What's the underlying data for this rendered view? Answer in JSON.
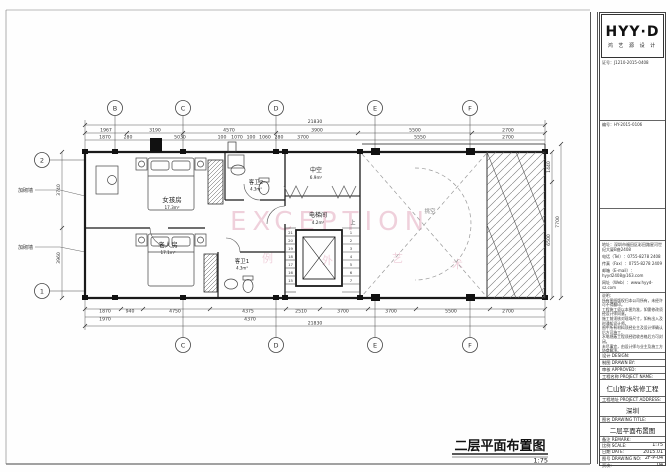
{
  "plan": {
    "axes_top": [
      "B",
      "C",
      "D",
      "E",
      "F"
    ],
    "axes_bottom": [
      "C",
      "D",
      "E",
      "F"
    ],
    "axes_left": [
      "2",
      "1"
    ],
    "dims": {
      "top_total": "21830",
      "top1": [
        "1967",
        "3190",
        "4570",
        "3900",
        "5500",
        "2700"
      ],
      "top2": [
        "1870",
        "280",
        "5030",
        "100",
        "1070",
        "100",
        "1060",
        "280",
        "3700",
        "5550",
        "2700"
      ],
      "bottom1": [
        "1870",
        "940",
        "4750",
        "4375",
        "2510",
        "3700",
        "3700",
        "5500",
        "2700"
      ],
      "bottom2": [
        "1970",
        "4370"
      ],
      "bottom_total": "21830",
      "right": [
        "1440",
        "6500",
        "7700"
      ],
      "left": [
        "3740",
        "3960"
      ]
    },
    "rooms": [
      {
        "name": "女孩房",
        "area": "17.3m²"
      },
      {
        "name": "客卫2",
        "area": "4.3m²"
      },
      {
        "name": "中空",
        "area": "6.9m²"
      },
      {
        "name": "电梯间",
        "area": "4.2m²"
      },
      {
        "name": "老人房",
        "area": "17.1m²"
      },
      {
        "name": "客卫1",
        "area": "4.3m²"
      },
      {
        "name": "挑空",
        "area": ""
      }
    ],
    "stairs": {
      "left": [
        "21",
        "20",
        "19",
        "18",
        "17",
        "16",
        "15"
      ],
      "right": [
        "1",
        "2",
        "3",
        "4",
        "5",
        "6",
        "7"
      ],
      "up": "上"
    },
    "notes": {
      "masonry_a": "加砌墙",
      "masonry_b": "加砌墙"
    },
    "watermark": {
      "word": "EXCEPTION",
      "char1": "例",
      "char2": "外",
      "char3": "艺",
      "char4": "术"
    }
  },
  "title_block": {
    "title": "二层平面布置图",
    "scale": "1:75"
  },
  "sidebar": {
    "logo": {
      "brand": "HYY·D",
      "sub": "鸿 艺 源 设 计"
    },
    "cert": "证号：J1210-2015-0408",
    "serial": "编号：HY-2015-0106",
    "company": {
      "address": "地址：深圳市福田区彩田路星河世纪大厦B座2408",
      "tel": "电话（Tel）：0755-8278 2408",
      "fax": "传真（Fax）：0755-8278 2409",
      "email": "邮箱（E-mail）：hyyd2408@163.com",
      "web": "网址（Web）：www.hyyd-sz.com"
    },
    "notes_title": "说明：",
    "notes": [
      "所有图纸版权归本公司所有，未经许可不得翻印。",
      "工程施工须以本图为准，如需修改须经设计师同意。",
      "施工前须核对现场尺寸，如有出入及时通知设计师。",
      "图中所有材料须经业主及设计师确认后方可施工。",
      "水电隐蔽工程须经验收合格后方可封闭。",
      "未尽事宜，由设计师与业主及施工方协商解决。"
    ],
    "design_label": "设计 DESIGN:",
    "drawn_label": "制图 DRAWN BY:",
    "approved_label": "审核 APPROVED:",
    "project_name_label": "工程名称 PROJECT NAME:",
    "project_name": "仁山智水装修工程",
    "project_addr_label": "工程地址 PROJECT ADDRESS:",
    "project_addr": "深圳",
    "drawing_title_label": "图名 DRAWING TITLE:",
    "drawing_title": "二层平面布置图",
    "remark_label": "备注 REMARK:",
    "scale_label": "比例 SCALE:",
    "scale": "1:75",
    "date_label": "日期 DATE:",
    "date": "2015.01",
    "no_label": "图号 DRAWING NO:",
    "no": "2F-P-04",
    "page_label": "页次:",
    "page": "04"
  }
}
